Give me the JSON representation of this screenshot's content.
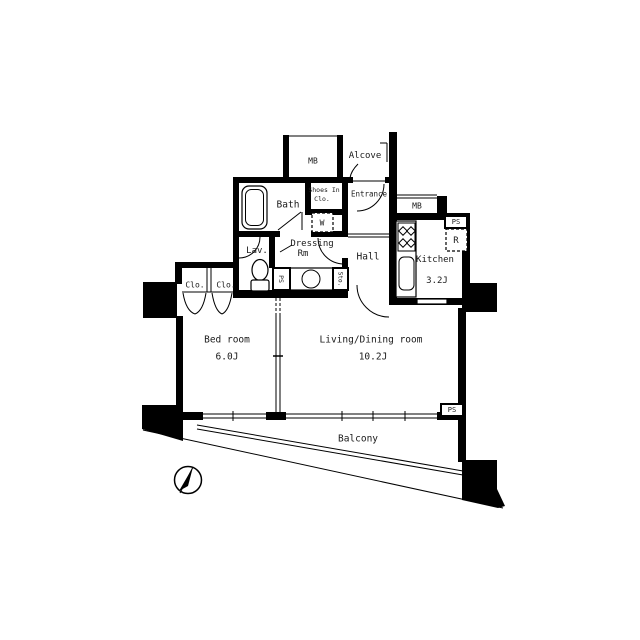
{
  "rooms": {
    "bedroom": {
      "name": "Bed room",
      "size": "6.0J"
    },
    "living_dining": {
      "name": "Living/Dining room",
      "size": "10.2J"
    },
    "kitchen": {
      "name": "Kitchen",
      "size": "3.2J"
    },
    "bath": {
      "name": "Bath"
    },
    "lavatory": {
      "name": "Lav."
    },
    "dressing_room": {
      "name_line1": "Dressing",
      "name_line2": "Rm"
    },
    "hall": {
      "name": "Hall"
    },
    "entrance": {
      "name": "Entrance"
    },
    "alcove": {
      "name": "Alcove"
    },
    "balcony": {
      "name": "Balcony"
    },
    "shoes_in_closet": {
      "name_line1": "Shoes In",
      "name_line2": "Clo."
    }
  },
  "fixtures": {
    "meter_box_top": "MB",
    "meter_box_kitchen": "MB",
    "washing_machine": "W",
    "refrigerator": "R",
    "pipe_space_dressing": "PS",
    "pipe_space_kitchen": "PS",
    "pipe_space_balcony": "PS",
    "storage": "Sto.",
    "closet_1": "Clo.",
    "closet_2": "Clo."
  },
  "colors": {
    "walls": "#000000",
    "background": "#ffffff",
    "text": "#1a1a1a"
  }
}
